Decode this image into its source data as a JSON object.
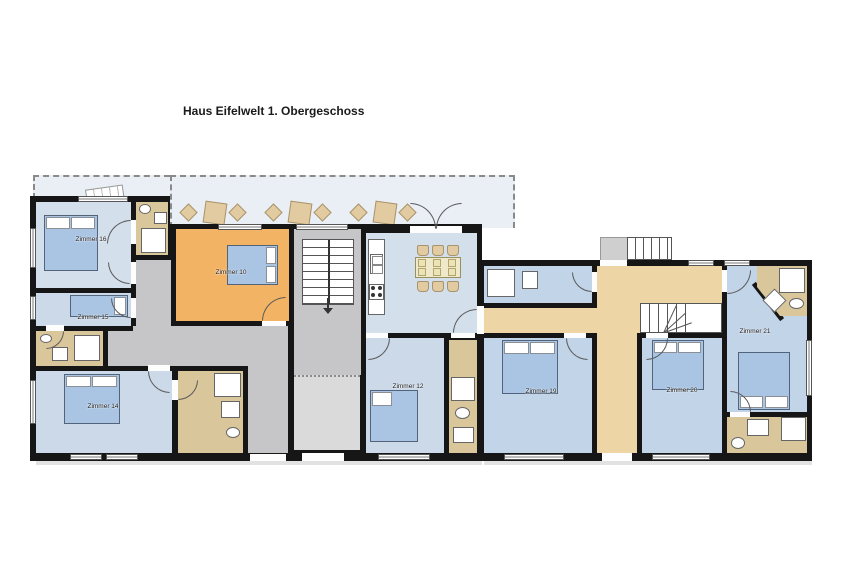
{
  "title": "Haus Eifelwelt 1. Obergeschoss",
  "rooms": {
    "zimmer16": "Zimmer 16",
    "zimmer15": "Zimmer 15",
    "zimmer14": "Zimmer 14",
    "zimmer10": "Zimmer 10",
    "zimmer12": "Zimmer 12",
    "zimmer19": "Zimmer 19",
    "zimmer20": "Zimmer 20",
    "zimmer21": "Zimmer 21"
  },
  "colors": {
    "wall": "#161616",
    "bedroom_blue": "#c2d4e8",
    "bedroom_blue_light": "#d4dfec",
    "orange_room": "#f3b364",
    "bathroom_tan": "#d9c69b",
    "hallway_beige": "#eed5a6",
    "corridor_gray": "#c6c6c8",
    "balcony_blue": "#eaeff5",
    "bed_blue": "#a9c5e3",
    "furniture_tan": "#e3cba1"
  }
}
